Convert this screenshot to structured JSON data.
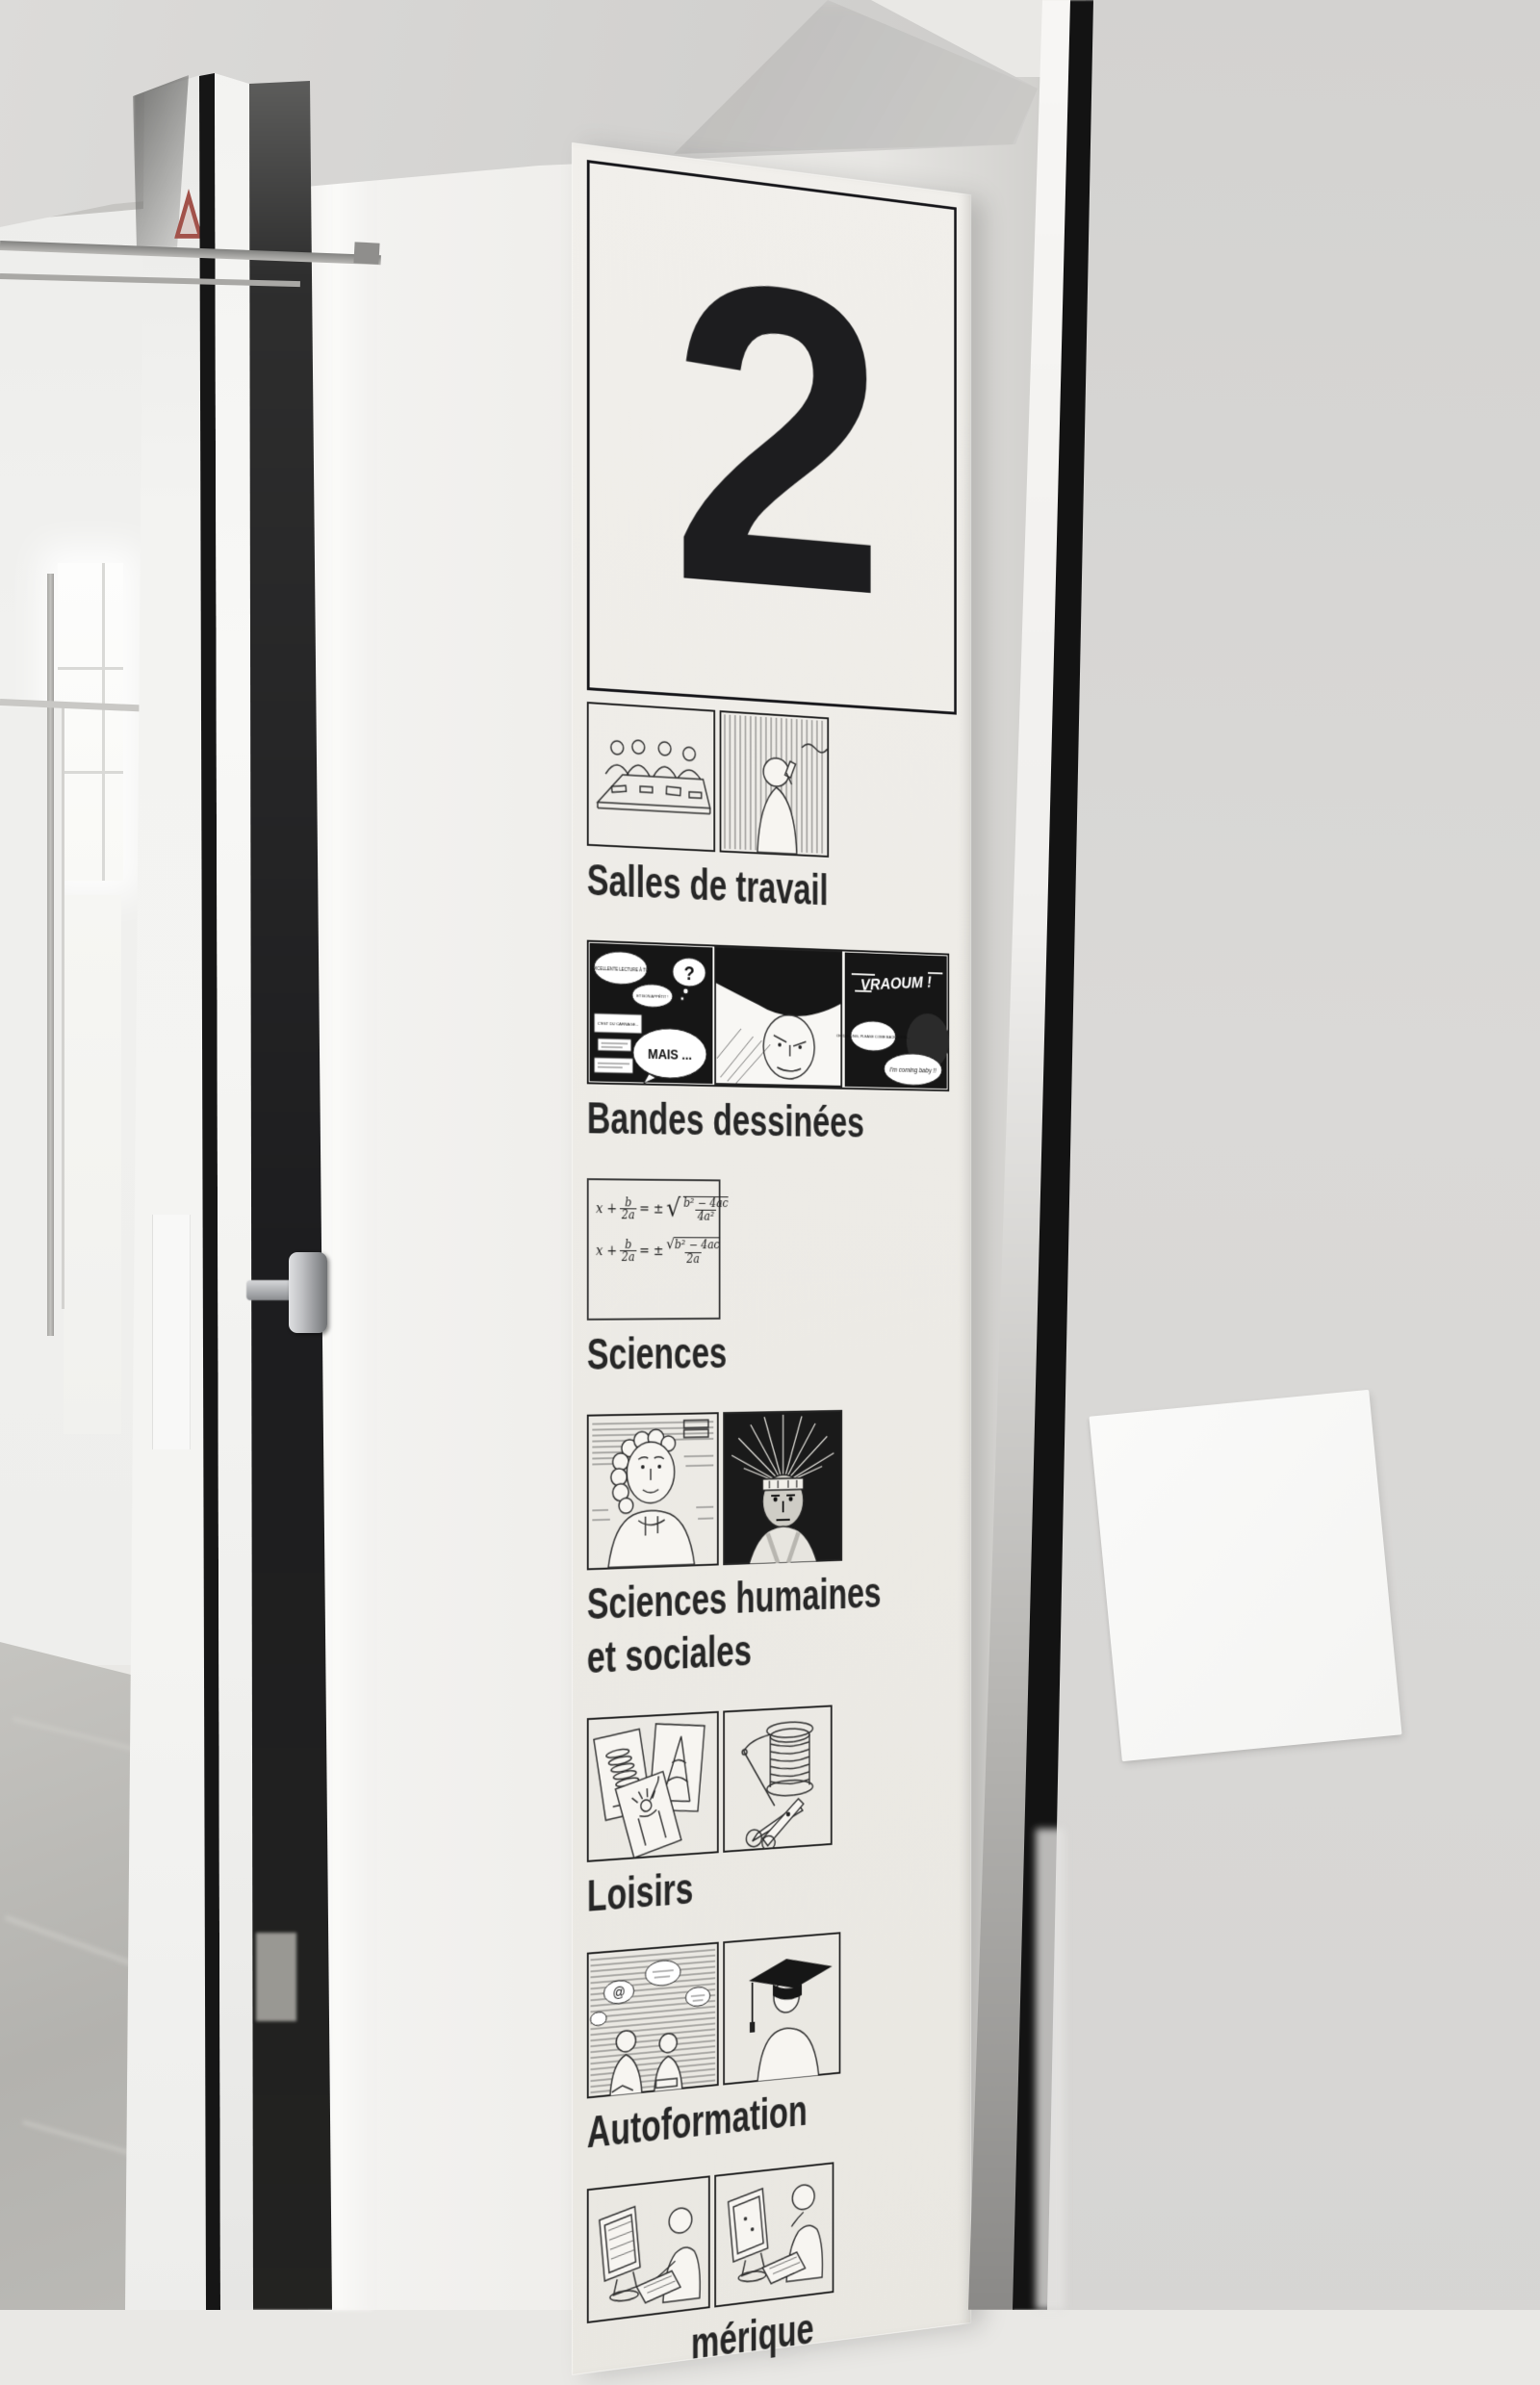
{
  "sign": {
    "floor_number": "2",
    "sections": [
      {
        "id": "salles-de-travail",
        "label": "Salles de travail"
      },
      {
        "id": "bandes-dessinees",
        "label": "Bandes dessinées"
      },
      {
        "id": "sciences",
        "label": "Sciences"
      },
      {
        "id": "sciences-humaines-et-sociales",
        "label": "Sciences humaines",
        "label_line2": "et sociales"
      },
      {
        "id": "loisirs",
        "label": "Loisirs"
      },
      {
        "id": "autoformation",
        "label": "Autoformation"
      },
      {
        "id": "espace-numerique",
        "label": "mérique"
      }
    ],
    "comic_texts": {
      "excellente": "EXCELLENTE LECTURE À TOI",
      "bon_appetit": "ET BON APPÉTIT !",
      "question": "?",
      "carnage": "C'EST DU CARNAGE...",
      "mais": "MAIS ...",
      "vraoum": "VRAOUM !",
      "darling": "OH DARLING, PLEASE COME BACK SOON...",
      "coming": "I'm coming baby !!"
    },
    "formula": {
      "lhs": "x +",
      "frac_num": "b",
      "frac_den": "2a",
      "eq": "= ±",
      "sqrt": "√",
      "rad1_num": "b² − 4ac",
      "rad1_den": "4a²",
      "rad2_num": "b² − 4ac",
      "rad2_den": "2a"
    }
  },
  "colors": {
    "sign_ink": "#1d1d1f",
    "sign_background": "#edebe6",
    "sticker_red": "#a2524a",
    "wall_gray": "#d6d5d3"
  }
}
